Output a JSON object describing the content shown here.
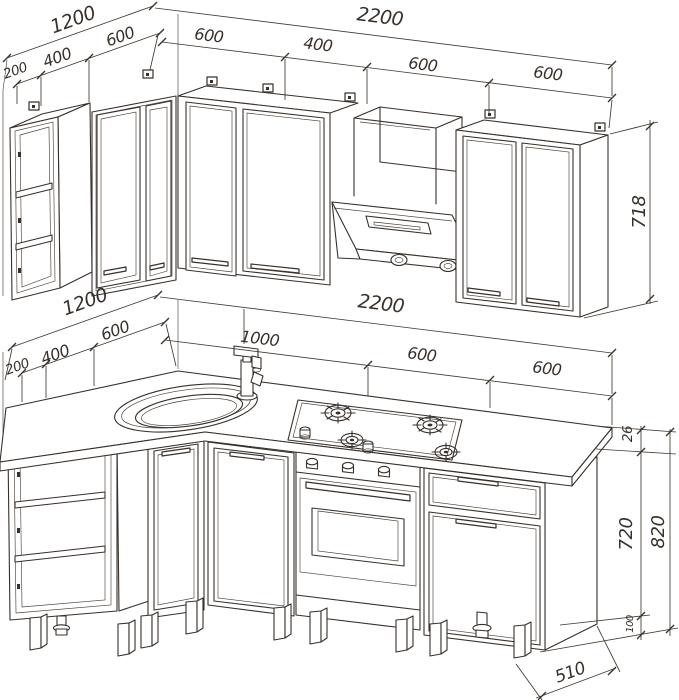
{
  "drawing": {
    "type": "kitchen corner set – technical line drawing, two isometric views",
    "line_color": "#38302a",
    "background": "#ffffff",
    "upper_view": {
      "name": "wall cabinets",
      "left_wall": {
        "total": "1200",
        "seg_200": "200",
        "seg_400": "400",
        "seg_600": "600"
      },
      "main_wall": {
        "total": "2200",
        "seg_1": "600",
        "seg_2": "400",
        "seg_3": "600",
        "seg_4": "600"
      },
      "cabinet_height": "718"
    },
    "lower_view": {
      "name": "base cabinets",
      "left_wall": {
        "total": "1200",
        "seg_200": "200",
        "seg_400": "400",
        "seg_600": "600"
      },
      "main_wall": {
        "total": "2200",
        "seg_1": "1000",
        "seg_2": "600",
        "seg_3": "600"
      },
      "worktop_thickness": "26",
      "body_height": "720",
      "total_height": "820",
      "leg_height": "100",
      "depth": "510"
    }
  }
}
